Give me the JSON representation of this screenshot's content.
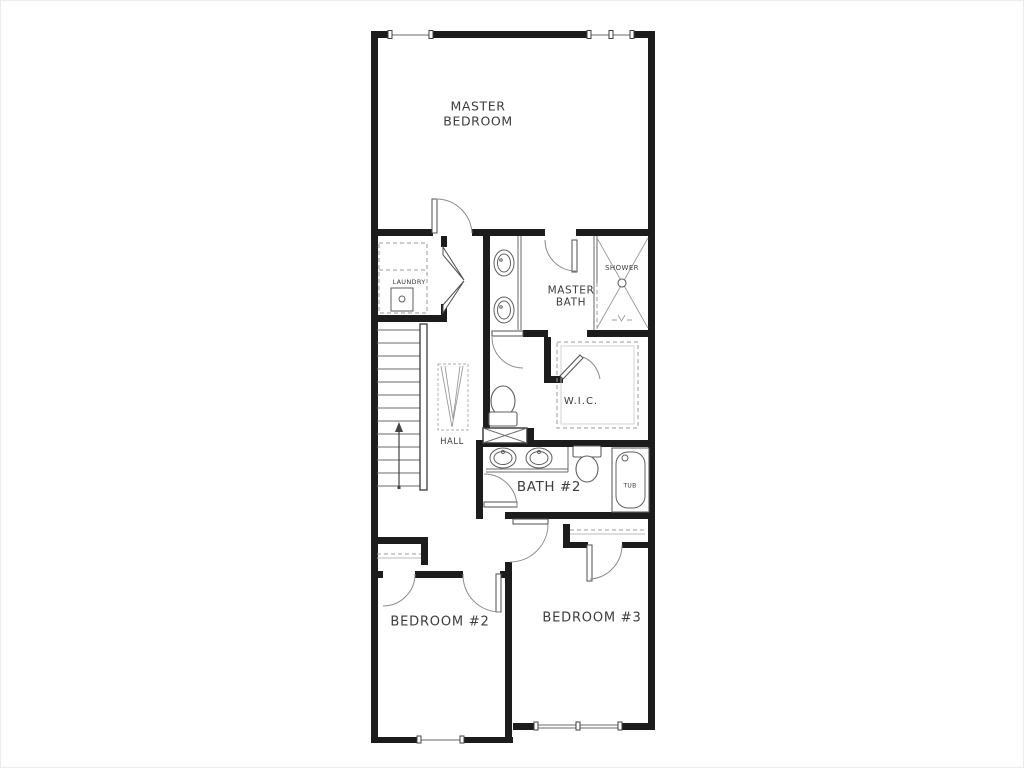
{
  "plan": {
    "labels": {
      "master_bedroom": "MASTER\nBEDROOM",
      "laundry": "LAUNDRY",
      "master_bath": "MASTER\nBATH",
      "shower": "SHOWER",
      "wic": "W.I.C.",
      "hall": "HALL",
      "bath2": "BATH #2",
      "tub": "TUB",
      "bedroom2": "BEDROOM #2",
      "bedroom3": "BEDROOM #3"
    },
    "colors": {
      "wall": "#1c1c1c",
      "fixture_line": "#5f5f5f",
      "dashed_line": "#9a9a9a",
      "label_text": "#3c3c3c",
      "background": "#ffffff"
    },
    "fixtures": [
      "stairs-up",
      "double-vanity",
      "single-vanity",
      "toilet",
      "shower-stall",
      "bathtub",
      "washer-dryer",
      "closet-shelves",
      "bifold-door",
      "window"
    ]
  }
}
